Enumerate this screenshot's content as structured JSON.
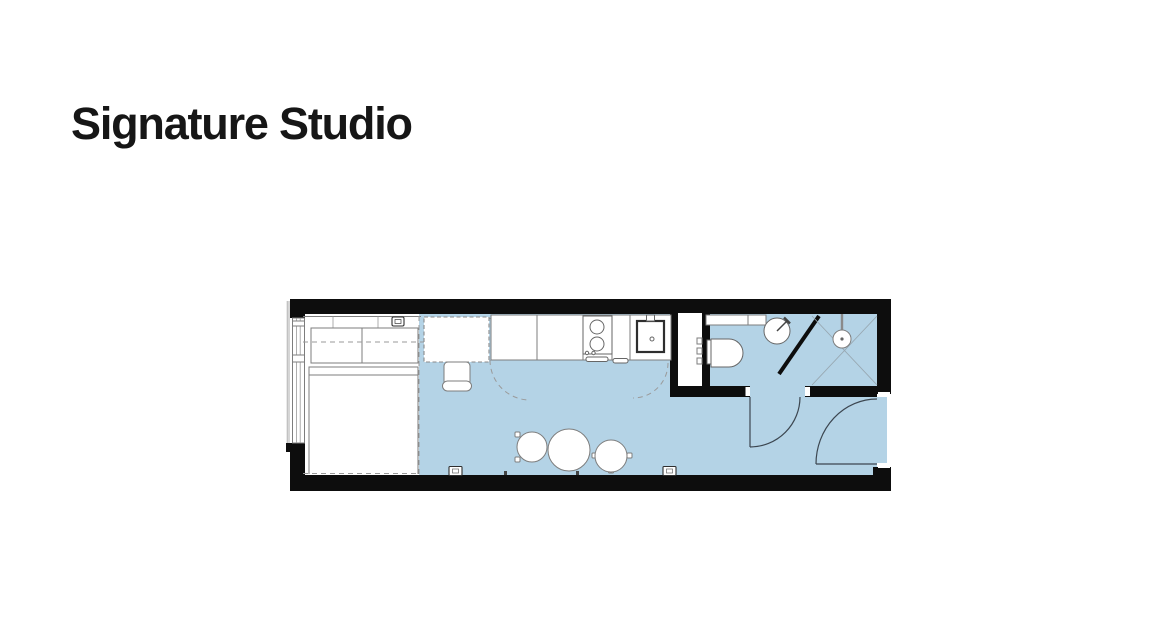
{
  "page": {
    "title": "Signature Studio"
  },
  "floor_plan": {
    "name": "signature-studio-floor-plan",
    "rooms": [
      "sleeping-area",
      "living-kitchen-area",
      "bathroom",
      "shower",
      "entry"
    ],
    "fixtures": [
      "window",
      "double-bed",
      "bedside-switch",
      "desk",
      "desk-chair",
      "kitchen-counter",
      "hob",
      "oven",
      "kitchen-sink",
      "wardrobe",
      "bathroom-shelf",
      "toilet",
      "wash-basin",
      "shower-drain",
      "dining-table",
      "stool-left",
      "stool-right",
      "bathroom-door",
      "entry-door",
      "power-socket",
      "power-socket"
    ]
  },
  "colors": {
    "page_bg": "#ffffff",
    "text": "#161616",
    "wall": "#0d0d0d",
    "floor": "#b4d3e6",
    "stroke": "#7d7d7d"
  }
}
